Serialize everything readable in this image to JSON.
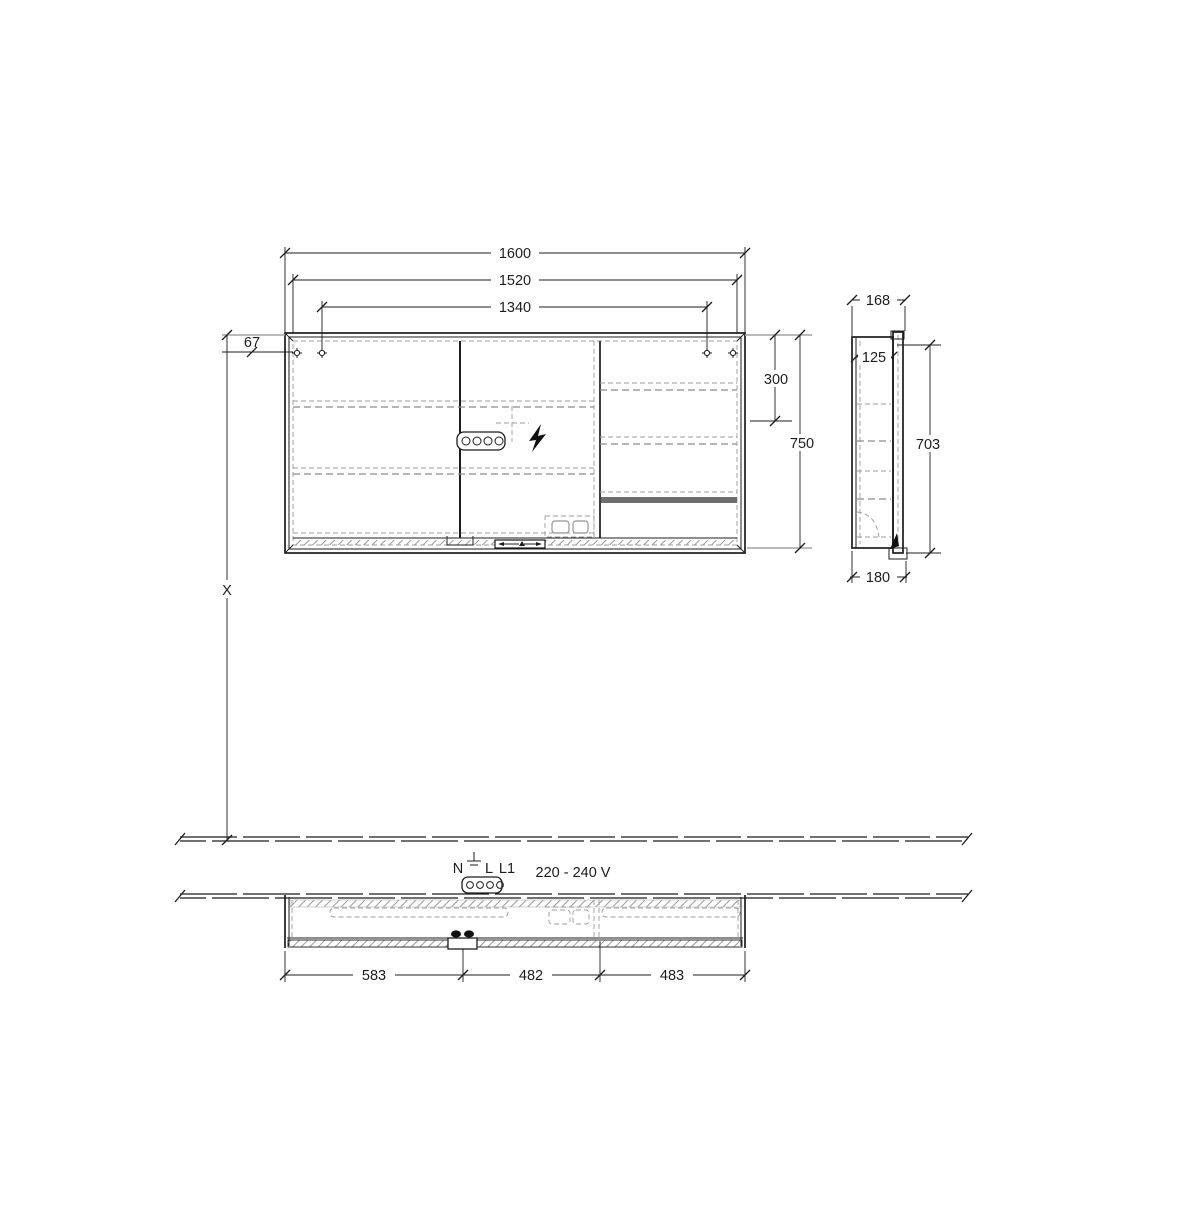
{
  "meta": {
    "title": "Mirror cabinet installation drawing"
  },
  "dims": {
    "front": {
      "total_width": "1600",
      "inner_width": "1520",
      "screw_spacing": "1340",
      "screw_top_offset": "67",
      "shelf_height": "300",
      "total_height": "750",
      "mounting_height": "X"
    },
    "side": {
      "total_depth": "168",
      "body_depth": "125",
      "carcass_height": "703",
      "bottom_depth": "180"
    },
    "plan": {
      "segment_left": "583",
      "segment_center": "482",
      "segment_right": "483"
    }
  },
  "electrical": {
    "terminal_n": "N",
    "terminal_l": "L",
    "terminal_l1": "L1",
    "voltage": "220 - 240 V"
  },
  "colors": {
    "line": "#1c1c1c",
    "gray_line": "#a3a3a3",
    "dashed": "#8c8c8c",
    "background": "#ffffff"
  }
}
